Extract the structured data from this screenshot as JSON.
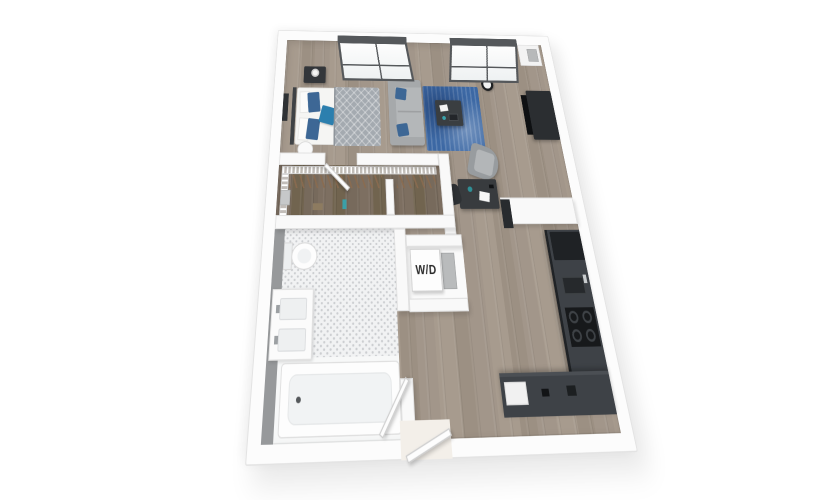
{
  "floorplan": {
    "unit_labels": {
      "washer_dryer": "W/D"
    },
    "rooms": [
      {
        "name": "sleeping-area"
      },
      {
        "name": "living-area"
      },
      {
        "name": "closet"
      },
      {
        "name": "bathroom"
      },
      {
        "name": "laundry-closet"
      },
      {
        "name": "kitchen"
      },
      {
        "name": "hallway-entry"
      }
    ],
    "palette": {
      "page_bg": "#ffffff",
      "wall": "#fcfcfc",
      "wall_edge": "#e1e1e1",
      "wood_floor": "#a2968a",
      "wood_floor_dark": "#776a5c",
      "tile": "#f1f2f3",
      "tile_dot": "#ccced1",
      "bath_accent_wall": "#97999b",
      "rug_blue": "#3c68a4",
      "pillow_blue": "#3d6795",
      "pillow_teal": "#2c7fae",
      "sofa_gray": "#b4b7b9",
      "duvet_gray": "#a4aab0",
      "furniture_dark": "#33363a",
      "tv_black": "#0e1012",
      "kitchen_cabinet": "#26292c",
      "kitchen_counter": "#3e4247",
      "window_frame": "#55585b",
      "chair_gray": "#9da1a4",
      "hanger_brown": "#8a6b4f"
    }
  }
}
